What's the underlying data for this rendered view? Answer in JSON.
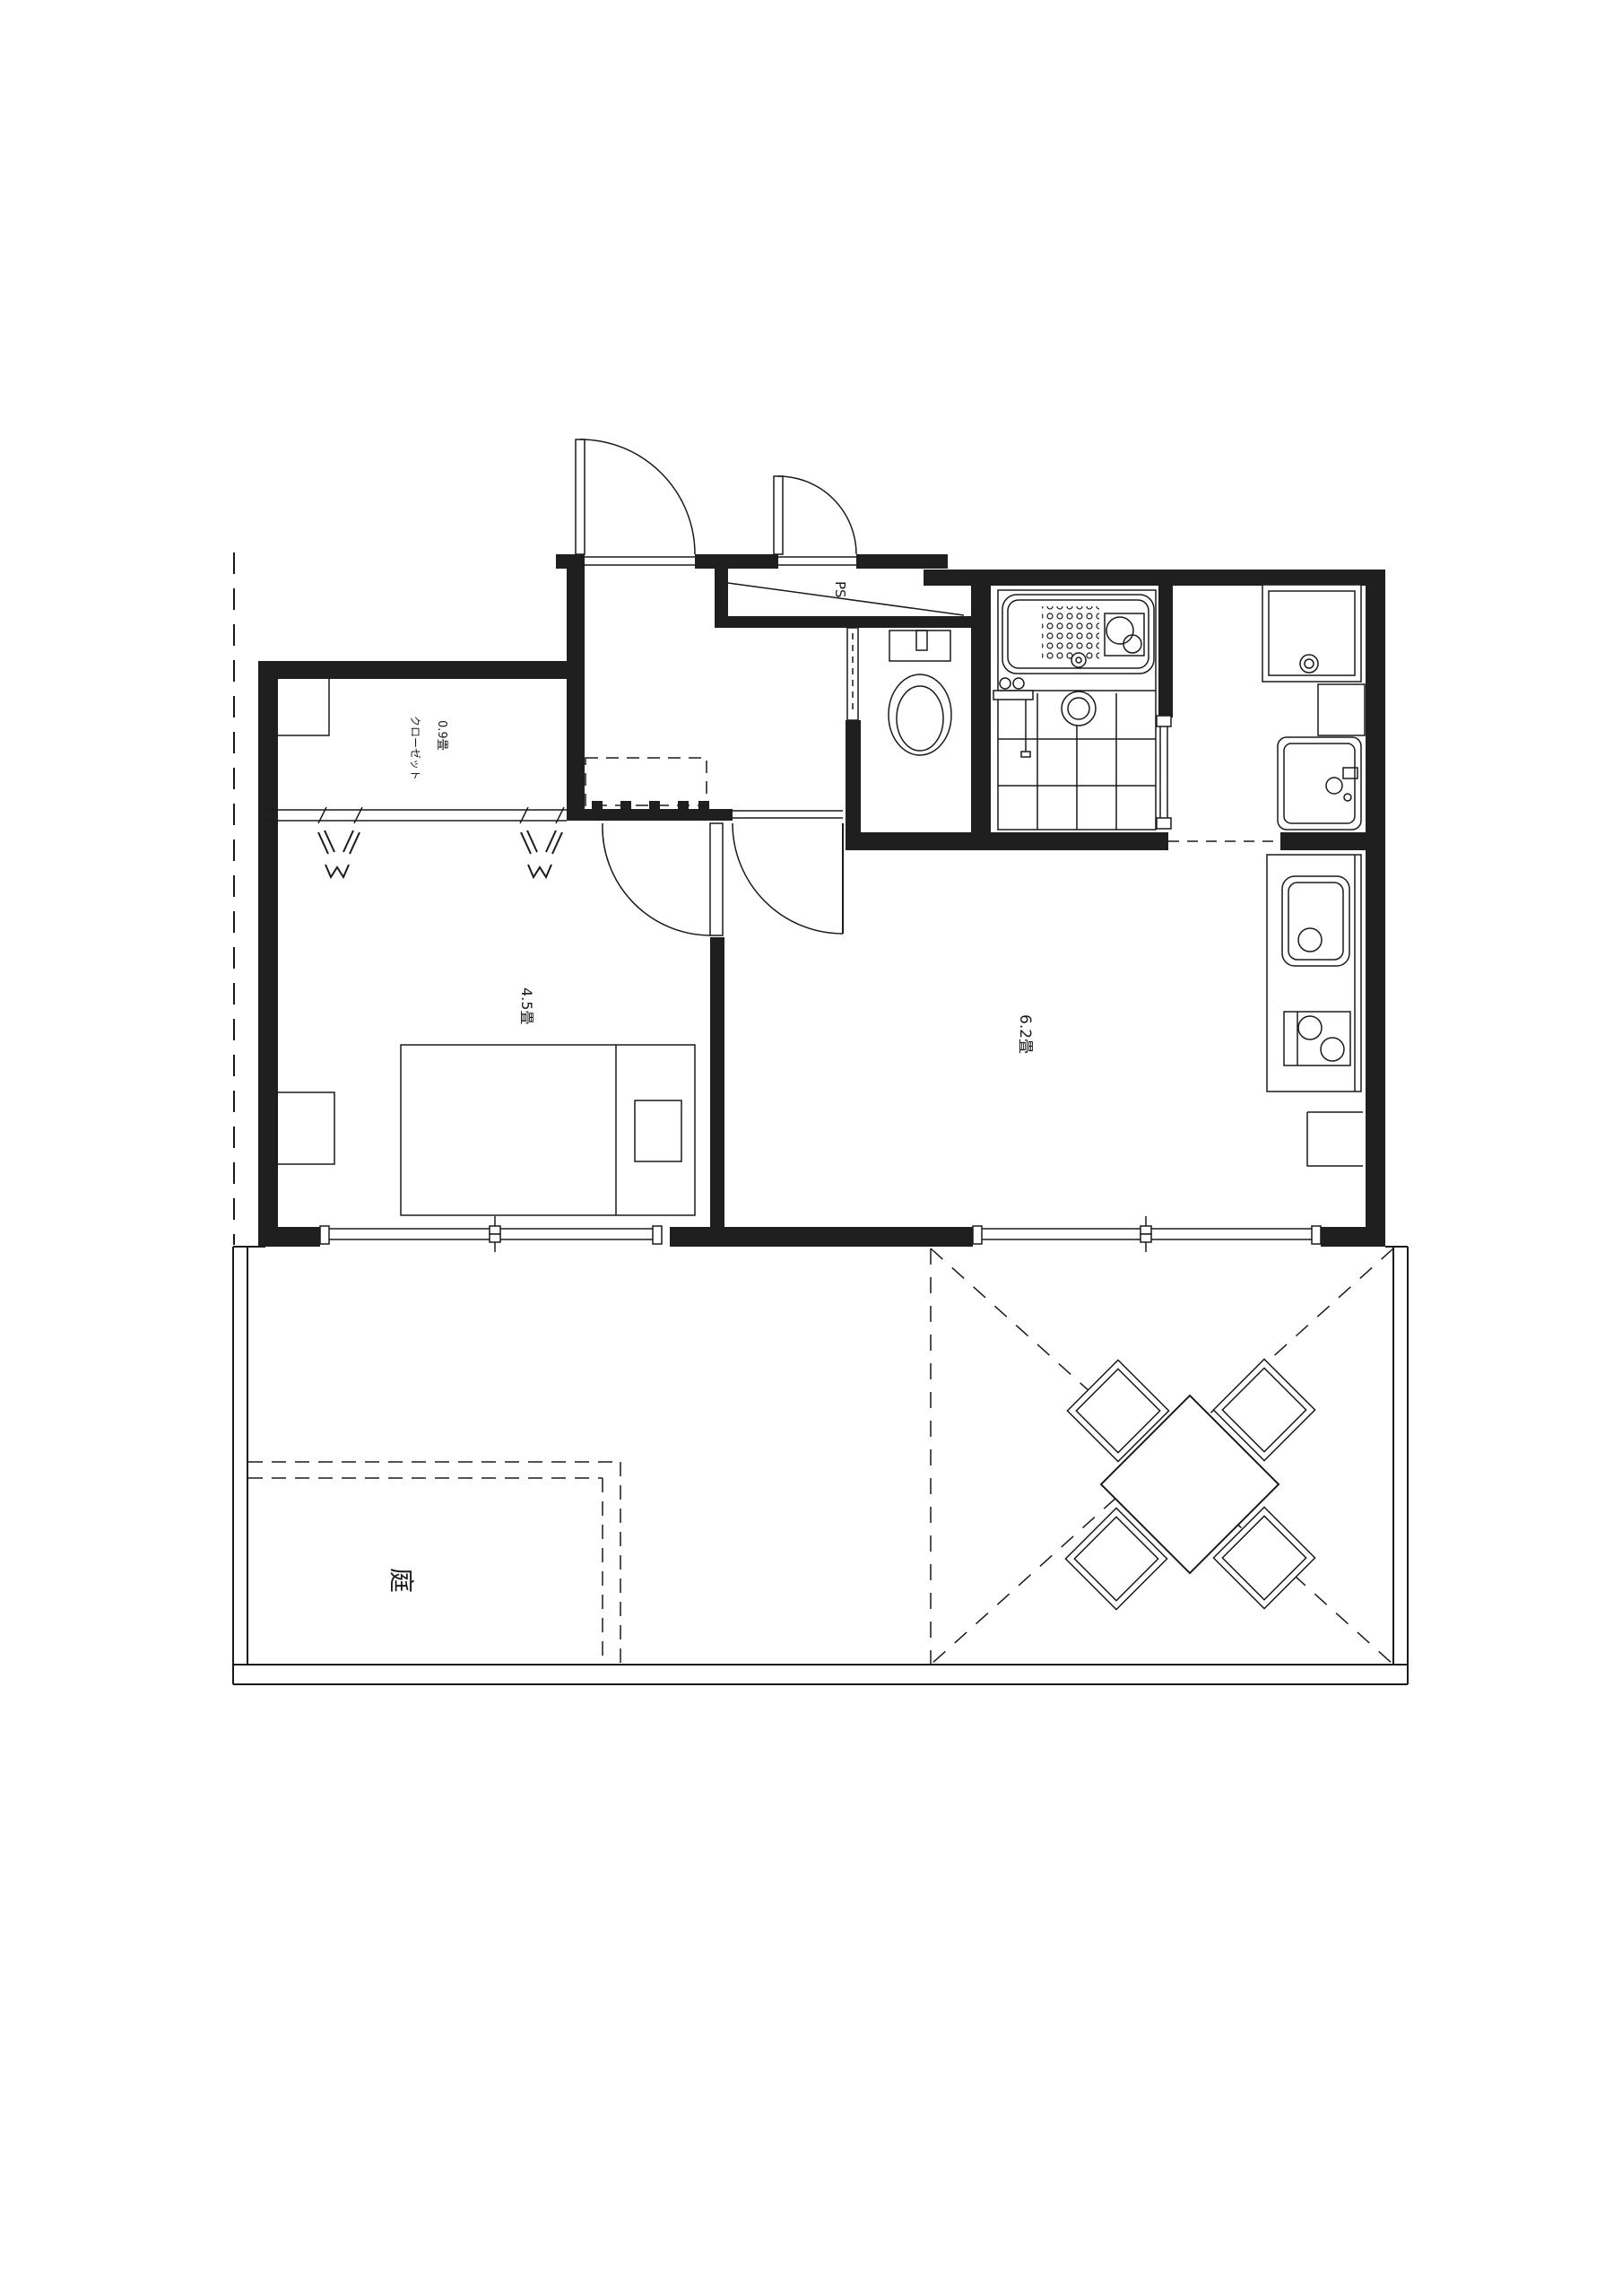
{
  "plan": {
    "title": "apartment-floor-plan",
    "colors": {
      "background": "#ffffff",
      "line": "#1a1a1a",
      "wall": "#1f1f1f"
    },
    "labels": {
      "closet_size": "0.9畳",
      "closet_name": "クローゼット",
      "bedroom_size": "4.5畳",
      "living_size": "6.2畳",
      "garden": "庭",
      "pipe_space": "PS"
    }
  }
}
